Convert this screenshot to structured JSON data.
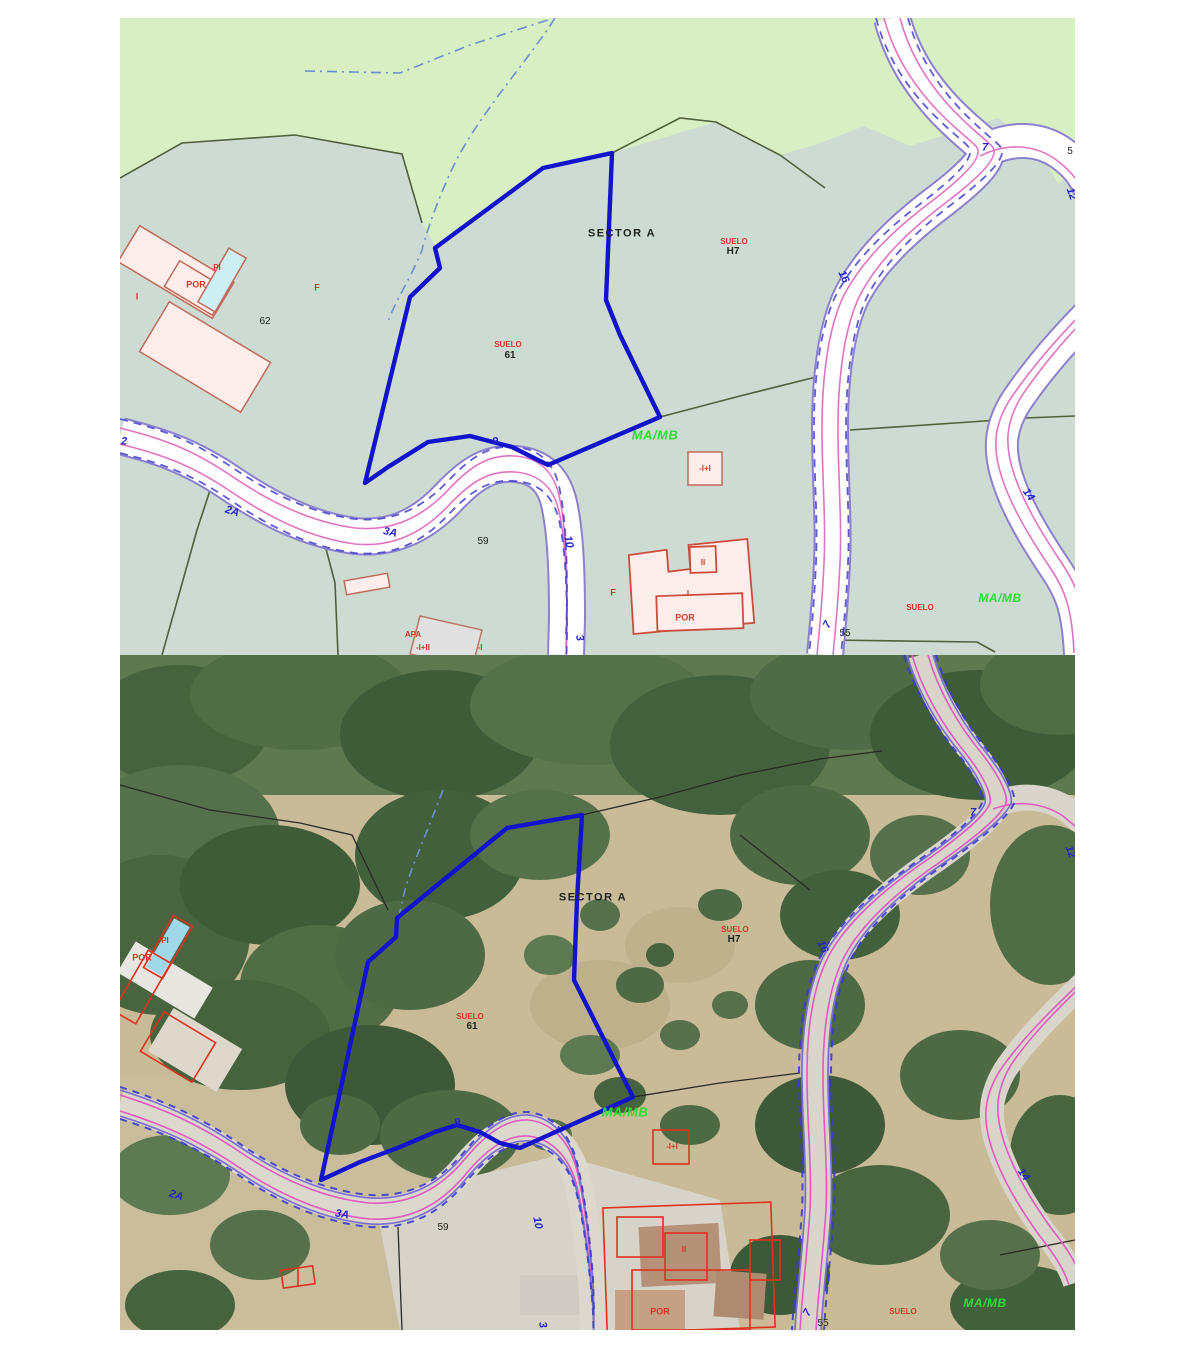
{
  "document": {
    "description_top": "Cadastral zoning plan panel",
    "description_bottom": "Aerial orthophoto panel with same overlay"
  },
  "labels": {
    "sector_a": "SECTOR A",
    "suelo": "SUELO",
    "h7": "H7",
    "n61": "61",
    "n62": "62",
    "n59": "59",
    "n55": "55",
    "n5": "5",
    "por": "POR",
    "pi": "PI",
    "f": "F",
    "i": "I",
    "ii": "II",
    "balcony": "-I+I",
    "balcony2": "-I+II",
    "minus_i": "-I",
    "apa": "APA",
    "mamb": "MA/MB",
    "r2": "2",
    "r2a": "2A",
    "r3a": "3A",
    "r9": "9",
    "r10": "10",
    "r3": "3",
    "r7": "7",
    "r16": "16",
    "r14": "14",
    "r12": "12"
  },
  "colors": {
    "parcel_boundary_blue": "#1313cd",
    "road_edge_purple": "#8d80cf",
    "road_inner_magenta": "#e273c4",
    "road_dashed_blue": "#4040cc",
    "cadastral_green": "#d8eec3",
    "cadastral_sage": "#cddbd2",
    "boundary_olive": "#51603c",
    "building_fill": "#fdeeec",
    "building_outline": "#c06a5a",
    "overlay_red": "#e03020",
    "pool_cyan": "#cdeef2",
    "label_red": "#cf3a28",
    "label_green": "#2ddc35",
    "label_blue": "#2424cc"
  }
}
